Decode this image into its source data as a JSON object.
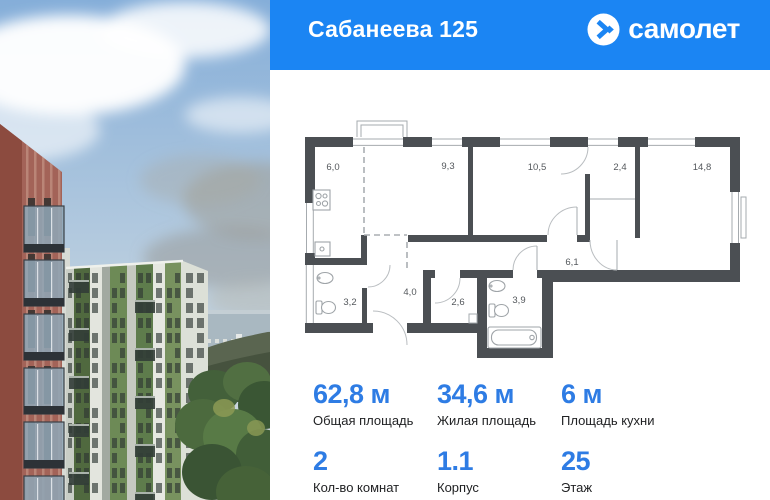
{
  "header": {
    "title": "Сабанеева 125",
    "logo_text": "самолет"
  },
  "floor_plan": {
    "rooms": [
      {
        "area": "6,0"
      },
      {
        "area": "9,3"
      },
      {
        "area": "10,5"
      },
      {
        "area": "2,4"
      },
      {
        "area": "14,8"
      },
      {
        "area": "6,1"
      },
      {
        "area": "3,2"
      },
      {
        "area": "4,0"
      },
      {
        "area": "2,6"
      },
      {
        "area": "3,9"
      }
    ]
  },
  "stats": {
    "areas": [
      {
        "value": "62,8 м",
        "label": "Общая площадь"
      },
      {
        "value": "34,6 м",
        "label": "Жилая площадь"
      },
      {
        "value": "6 м",
        "label": "Площадь кухни"
      }
    ],
    "details": [
      {
        "value": "2",
        "label": "Кол-во комнат"
      },
      {
        "value": "1.1",
        "label": "Корпус"
      },
      {
        "value": "25",
        "label": "Этаж"
      }
    ]
  },
  "colors": {
    "accent_blue": "#1b85f3",
    "value_blue": "#2e7ce4",
    "plan_wall": "#4b4f53"
  }
}
